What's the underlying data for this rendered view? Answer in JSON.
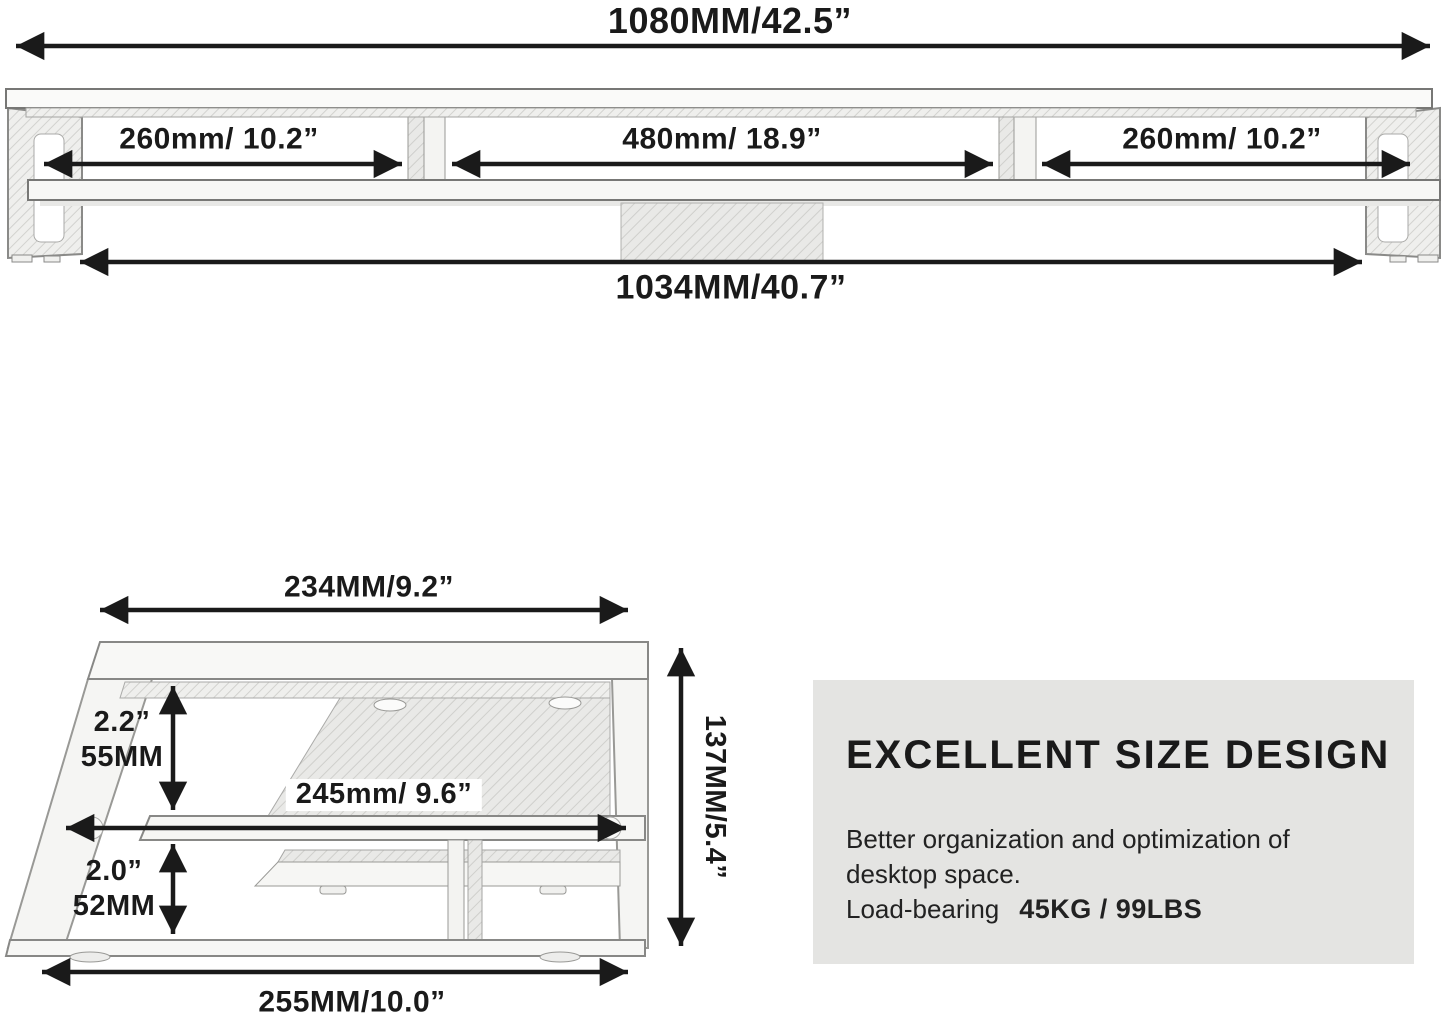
{
  "front_view": {
    "overall_width": "1080MM/42.5”",
    "left_section": "260mm/ 10.2”",
    "middle_section": "480mm/ 18.9”",
    "right_section": "260mm/ 10.2”",
    "base_width": "1034MM/40.7”"
  },
  "side_view": {
    "top_depth": "234MM/9.2”",
    "upper_clearance_in": "2.2”",
    "upper_clearance_mm": "55MM",
    "shelf_depth": "245mm/ 9.6”",
    "lower_clearance_in": "2.0”",
    "lower_clearance_mm": "52MM",
    "total_height": "137MM/5.4”",
    "base_depth": "255MM/10.0”"
  },
  "info_box": {
    "heading": "EXCELLENT SIZE DESIGN",
    "body_line1": "Better organization and optimization of",
    "body_line2": "desktop space.",
    "load_label": "Load-bearing",
    "load_value": "45KG / 99LBS"
  },
  "colors": {
    "arrow": "#1a1a1a",
    "text": "#1a1a1a",
    "outline": "#8a8a88",
    "fill_light": "#f7f7f5",
    "hatch_bg": "#efefed",
    "hatch_line": "#d2d2cf",
    "box_bg": "#e4e4e2"
  }
}
